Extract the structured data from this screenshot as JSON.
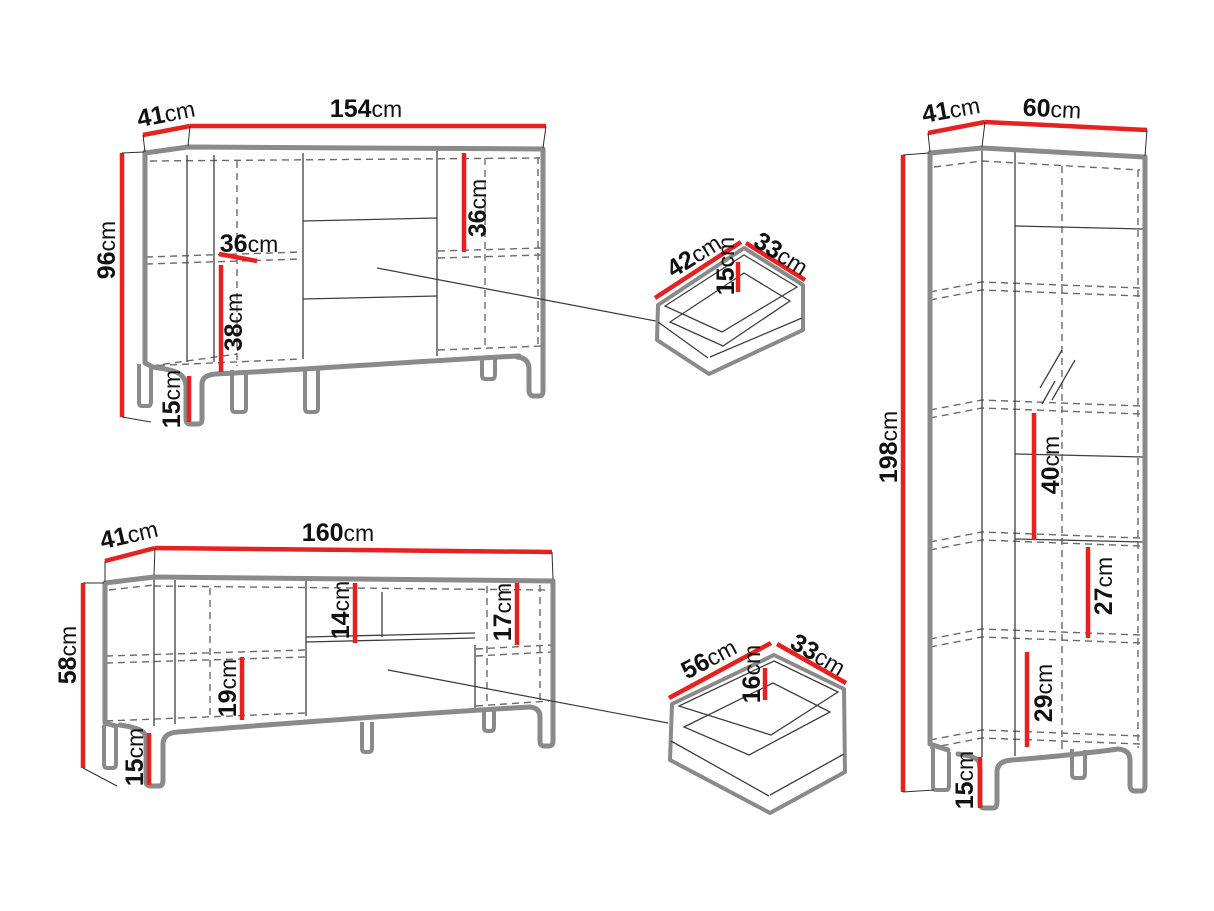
{
  "unit": "cm",
  "dims": {
    "sideboard": {
      "width": "154",
      "depth": "41",
      "height": "96",
      "shelf_width": "36",
      "right_section_height": "36",
      "left_section_height": "38",
      "leg_height": "15"
    },
    "drawer_top": {
      "width": "42",
      "depth": "33",
      "inner_height": "15"
    },
    "tall_cabinet": {
      "width": "60",
      "depth": "41",
      "height": "198",
      "upper_shelf_height": "40",
      "middle_shelf_height": "27",
      "lower_shelf_height": "29",
      "leg_height": "15"
    },
    "tv_stand": {
      "width": "160",
      "depth": "41",
      "height": "58",
      "niche_height": "14",
      "right_section_height": "17",
      "left_section_height": "19",
      "leg_height": "15"
    },
    "drawer_bottom": {
      "width": "56",
      "depth": "33",
      "inner_height": "16"
    }
  },
  "colors": {
    "dimension": "#e8201e",
    "outline": "#8a8a8a",
    "line": "#3f3f3f",
    "dashed": "#6a6a6a",
    "text": "#111111",
    "background": "#ffffff"
  }
}
